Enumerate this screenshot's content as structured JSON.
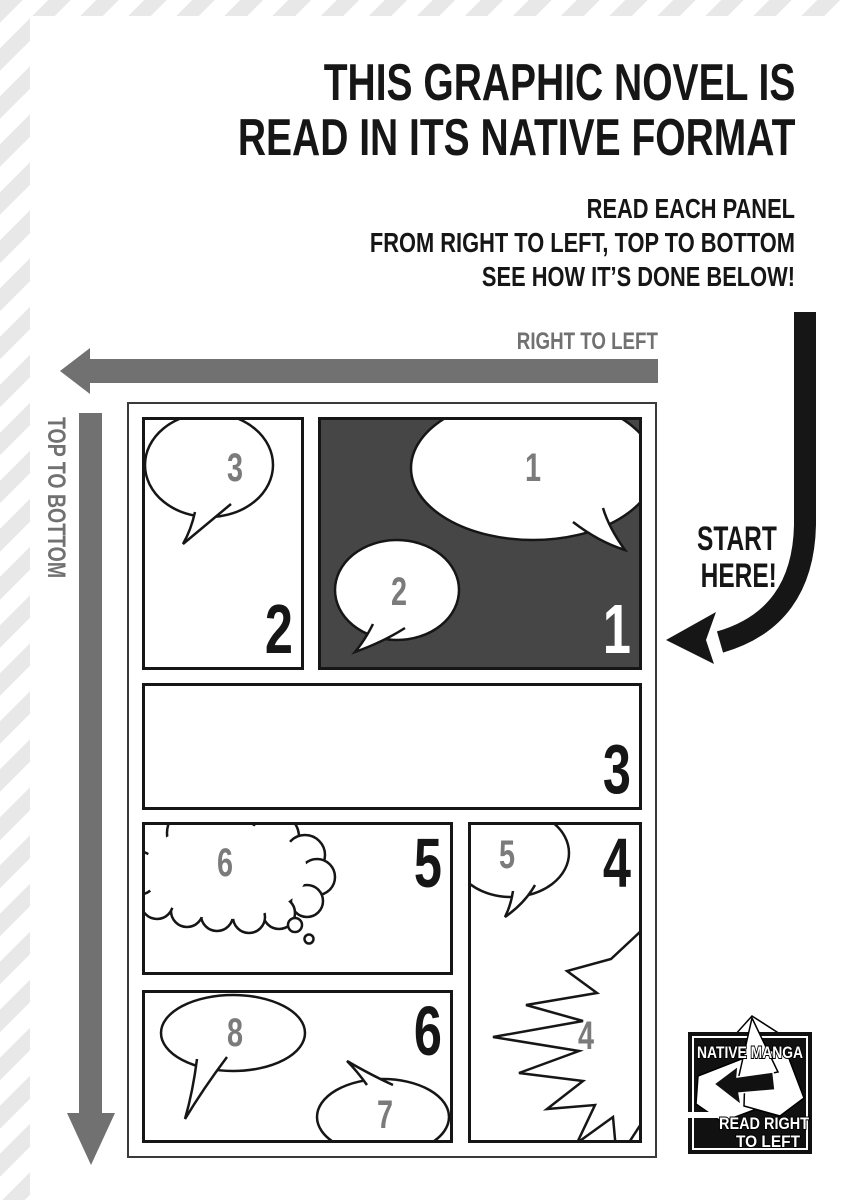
{
  "header": {
    "title_line1": "THIS GRAPHIC NOVEL IS",
    "title_line2": "READ IN ITS NATIVE FORMAT",
    "subtitle_line1": "READ EACH PANEL",
    "subtitle_line2": "FROM RIGHT TO LEFT, TOP TO BOTTOM",
    "subtitle_line3": "SEE HOW IT’S DONE BELOW!"
  },
  "guides": {
    "horizontal_arrow_label": "RIGHT TO LEFT",
    "vertical_arrow_label": "TOP TO BOTTOM",
    "start_line1": "START",
    "start_line2": "HERE!"
  },
  "comic_page": {
    "panels": [
      {
        "id": "panel-1",
        "number": "1",
        "style": "dark",
        "bubbles": [
          "1",
          "2"
        ]
      },
      {
        "id": "panel-2",
        "number": "2",
        "style": "light",
        "bubbles": [
          "3"
        ]
      },
      {
        "id": "panel-3",
        "number": "3",
        "style": "light",
        "bubbles": []
      },
      {
        "id": "panel-4",
        "number": "4",
        "style": "light",
        "bubbles": [
          "5",
          "4"
        ]
      },
      {
        "id": "panel-5",
        "number": "5",
        "style": "light",
        "bubbles": [
          "6"
        ]
      },
      {
        "id": "panel-6",
        "number": "6",
        "style": "light",
        "bubbles": [
          "8",
          "7"
        ]
      }
    ]
  },
  "logo": {
    "line_top": "NATIVE MANGA",
    "line_bottom1": "READ RIGHT",
    "line_bottom2": "TO LEFT"
  },
  "colors": {
    "ink": "#161616",
    "guide_gray": "#717171",
    "bubble_number_gray": "#7b7b7b",
    "panel_dark_fill": "#464646",
    "stripe_gray": "#e8e8e8"
  }
}
